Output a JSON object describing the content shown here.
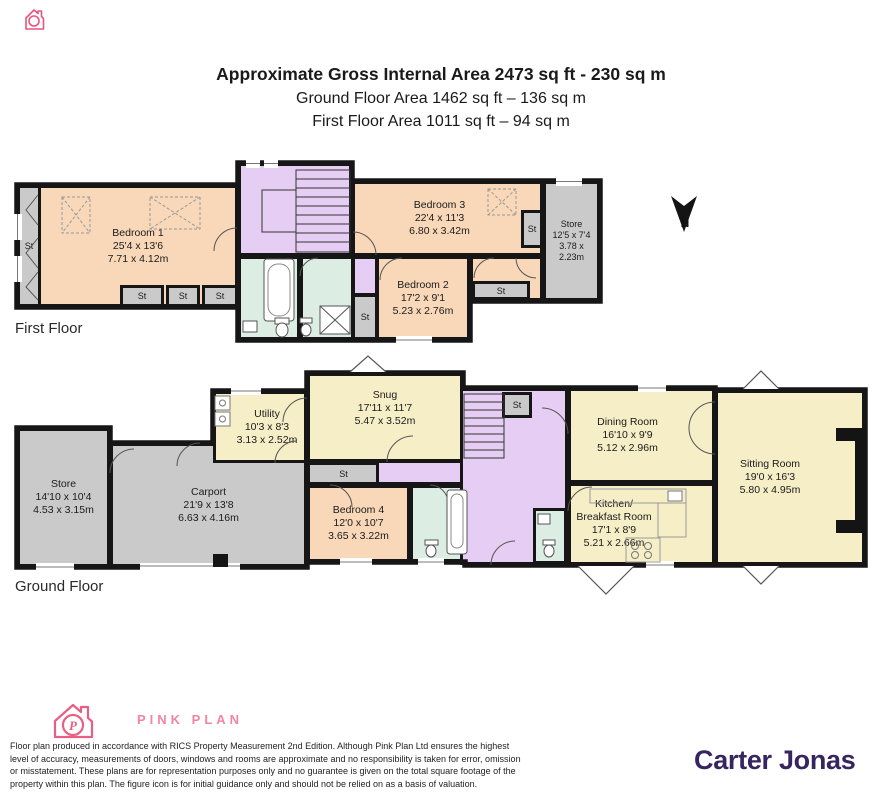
{
  "header": {
    "title": "Approximate Gross Internal Area 2473 sq ft - 230 sq m",
    "subtitle_ground": "Ground Floor Area 1462 sq ft – 136 sq m",
    "subtitle_first": "First Floor Area 1011 sq ft – 94 sq m"
  },
  "labels": {
    "st": "St",
    "first_floor": "First Floor",
    "ground_floor": "Ground Floor"
  },
  "compass": {
    "north": "N"
  },
  "first_floor_rooms": {
    "bedroom1": {
      "name": "Bedroom 1",
      "imperial": "25'4 x 13'6",
      "metric": "7.71 x 4.12m"
    },
    "bedroom2": {
      "name": "Bedroom 2",
      "imperial": "17'2 x 9'1",
      "metric": "5.23 x 2.76m"
    },
    "bedroom3": {
      "name": "Bedroom 3",
      "imperial": "22'4 x 11'3",
      "metric": "6.80 x 3.42m"
    },
    "store": {
      "name": "Store",
      "imperial": "12'5 x 7'4",
      "metric": "3.78 x 2.23m"
    }
  },
  "ground_floor_rooms": {
    "store": {
      "name": "Store",
      "imperial": "14'10 x 10'4",
      "metric": "4.53 x 3.15m"
    },
    "carport": {
      "name": "Carport",
      "imperial": "21'9 x 13'8",
      "metric": "6.63 x 4.16m"
    },
    "utility": {
      "name": "Utility",
      "imperial": "10'3 x 8'3",
      "metric": "3.13 x 2.52m"
    },
    "snug": {
      "name": "Snug",
      "imperial": "17'11 x 11'7",
      "metric": "5.47 x 3.52m"
    },
    "bedroom4": {
      "name": "Bedroom 4",
      "imperial": "12'0 x 10'7",
      "metric": "3.65 x 3.22m"
    },
    "dining": {
      "name": "Dining Room",
      "imperial": "16'10 x 9'9",
      "metric": "5.12 x 2.96m"
    },
    "kitchen": {
      "name_line1": "Kitchen/",
      "name_line2": "Breakfast Room",
      "imperial": "17'1 x 8'9",
      "metric": "5.21 x 2.66m"
    },
    "sitting": {
      "name": "Sitting Room",
      "imperial": "19'0 x 16'3",
      "metric": "5.80 x 4.95m"
    }
  },
  "footer": {
    "brand": "PINK PLAN",
    "logo_letter": "P",
    "disclaimer": "Floor plan produced in accordance with RICS Property Measurement 2nd Edition. Although Pink Plan Ltd ensures the highest level of accuracy, measurements of doors, windows and rooms are approximate and no responsibility is taken for error, omission or misstatement. These plans are for representation purposes only and no guarantee is given on the total square footage of the property within this plan. The figure icon is for initial guidance only and should not be relied on as a basis of valuation.",
    "agent": "Carter Jonas"
  },
  "colors": {
    "room_peach": "#f8d8b8",
    "room_cream": "#f6eec6",
    "room_lavender": "#e5cdf3",
    "room_mint": "#dceee3",
    "room_gray": "#cacaca",
    "wall": "#161616",
    "brand_pink": "#f0869f",
    "agent_purple": "#37255f"
  }
}
